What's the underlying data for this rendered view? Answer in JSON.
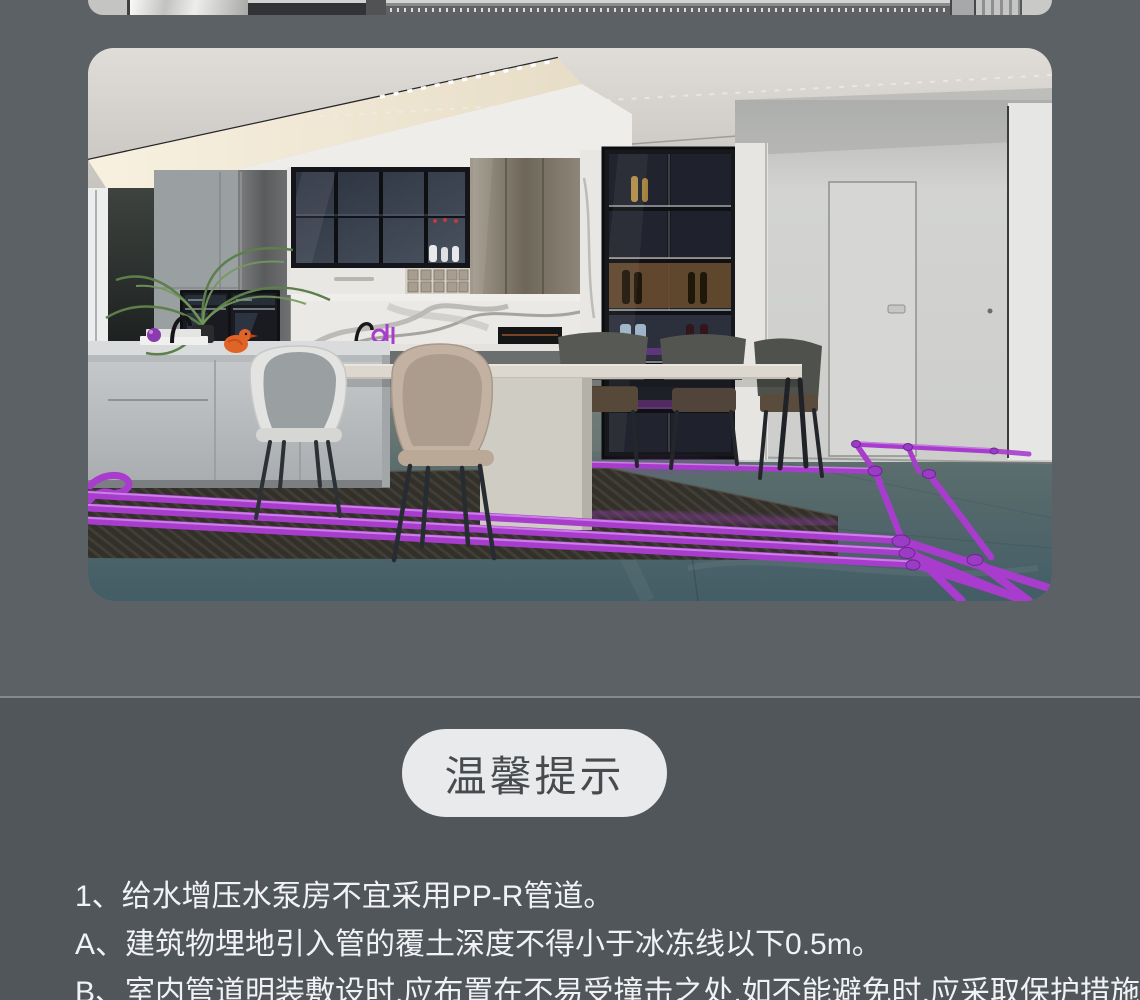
{
  "palette": {
    "bg_top": "#5c6165",
    "bg_bottom": "#51565b",
    "divider": "#84898d",
    "pill_bg": "#e9eaeb",
    "pill_text": "#474b4e",
    "note_text": "#f1f2f4",
    "pipe": "#a83ccc",
    "pipe_light": "#d89df0",
    "pipe_dark": "#7b2aa4"
  },
  "tip_badge": {
    "label": "温馨提示"
  },
  "notes": {
    "items": [
      {
        "text": "1、给水增压水泵房不宜采用PP-R管道。"
      },
      {
        "text": "A、建筑物埋地引入管的覆土深度不得小于冰冻线以下0.5m。"
      },
      {
        "text": "B、室内管道明装敷设时,应布置在不易受撞击之处,如不能避免时,应采取保护措施。"
      }
    ]
  }
}
